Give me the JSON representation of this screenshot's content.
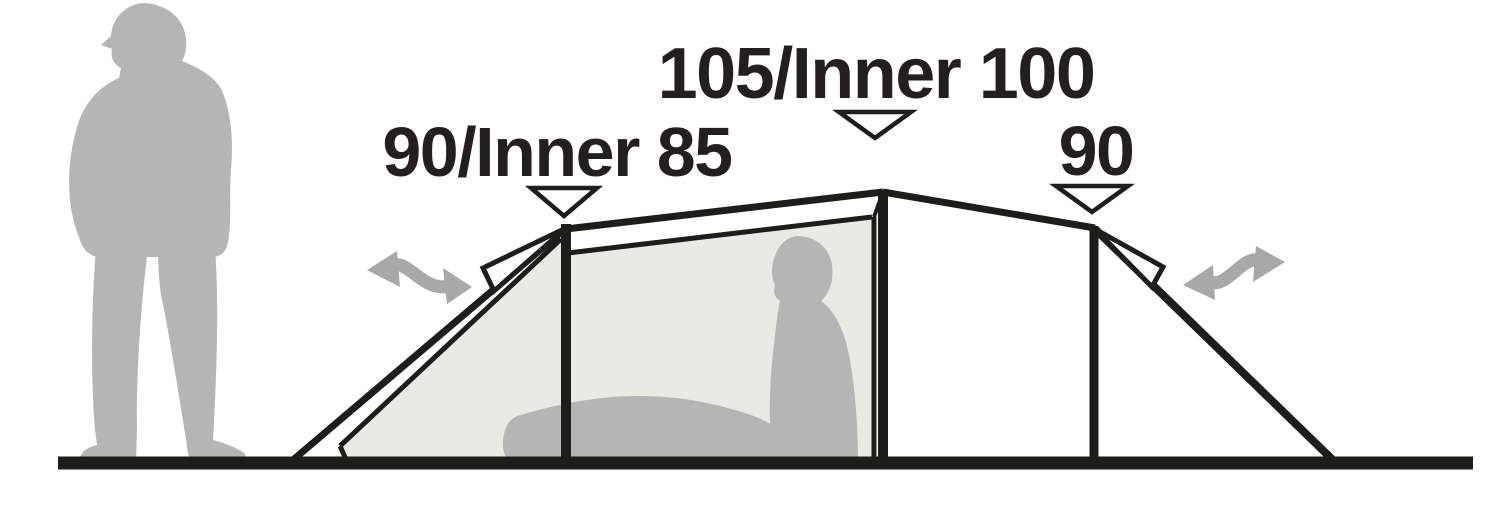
{
  "figure": {
    "type": "tent-dimension-side-profile-diagram",
    "measurements": {
      "left": {
        "label": "90/Inner 85",
        "flysheet_height_cm": 90,
        "inner_height_cm": 85
      },
      "center": {
        "label": "105/Inner 100",
        "flysheet_height_cm": 105,
        "inner_height_cm": 100
      },
      "right": {
        "label": "90",
        "flysheet_height_cm": 90
      }
    },
    "icons": {
      "standing_person": "standing-person-silhouette",
      "seated_person": "seated-person-in-tent-silhouette",
      "left_arrow": "double-headed-wavy-arrow",
      "right_arrow": "double-headed-wavy-arrow",
      "marker": "downward-triangle-pointer"
    },
    "colors": {
      "line": "#1d1d1b",
      "label": "#231f20",
      "silhouette": "#b5b5b5",
      "inner_fill": "#e9eae6",
      "arrow": "#a8a8a8",
      "marker_fill": "#ffffff",
      "background": "#ffffff"
    }
  }
}
